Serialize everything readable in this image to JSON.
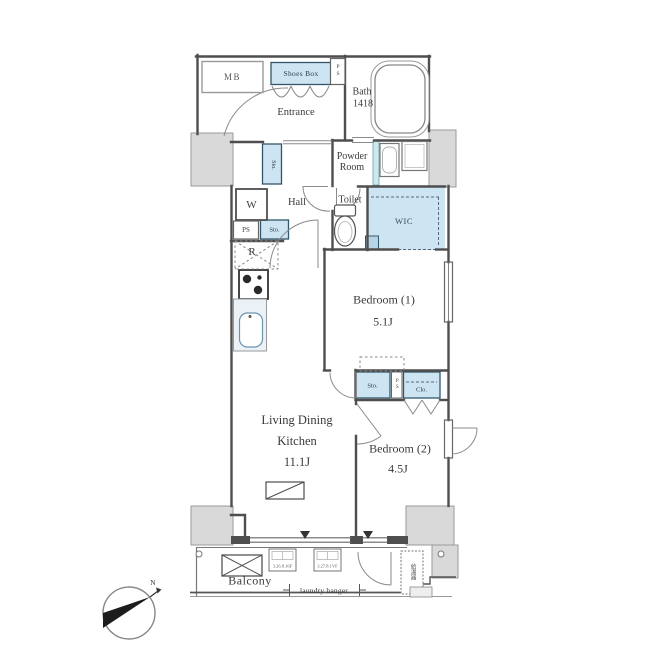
{
  "colors": {
    "wall": "#4e4e4e",
    "thin_line": "#8a8a8a",
    "gray_fill": "#d9d9d9",
    "storage_fill": "#cde4f2",
    "text": "#3a3a3a"
  },
  "floorplan": {
    "entry": {
      "mb": "MB",
      "shoes_box": "Shoes Box",
      "ps": "PS",
      "entrance": "Entrance",
      "sto": "Sto."
    },
    "wet_area": {
      "bath_name": "Bath",
      "bath_size": "1418",
      "powder_room": "Powder Room",
      "toilet": "Toilet",
      "wic": "WIC",
      "washer": "W"
    },
    "hall": {
      "name": "Hall",
      "ps": "PS",
      "sto": "Sto.",
      "fridge": "R"
    },
    "bedroom1": {
      "name": "Bedroom (1)",
      "size": "5.1J"
    },
    "storage_row": {
      "sto": "Sto.",
      "ps": "PS",
      "clo": "Clo."
    },
    "ldk": {
      "line1": "Living Dining",
      "line2": "Kitchen",
      "size": "11.1J"
    },
    "bedroom2": {
      "name": "Bedroom (2)",
      "size": "4.5J"
    },
    "balcony": {
      "name": "Balcony",
      "laundry_hanger": "laundry hanger",
      "water_heater": "給湯器",
      "note_left": "3.26.8.16F",
      "note_right": "3.27.8.1VF"
    },
    "compass": {
      "north": "N"
    }
  }
}
